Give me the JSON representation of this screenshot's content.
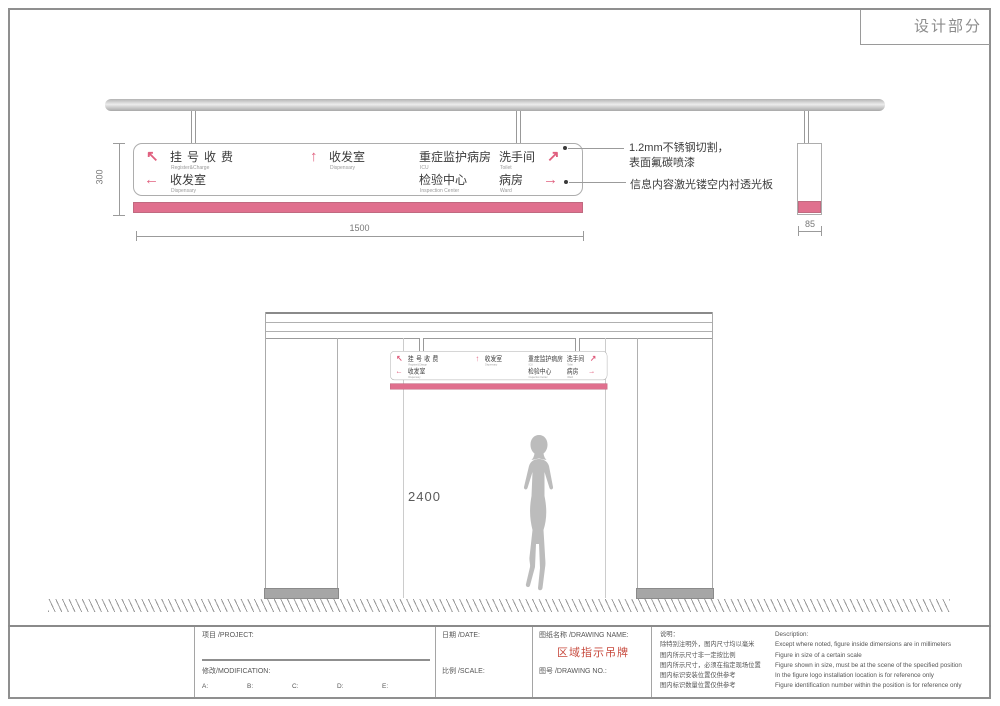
{
  "page": {
    "corner_label": "设计部分"
  },
  "colors": {
    "pink_band": "#e0708e",
    "arrow_pink": "#e0607f",
    "drawing_name_red": "#c84b3f"
  },
  "main_sign": {
    "row1": {
      "arrow_upleft": "↖",
      "dest1_cn": "挂号收费",
      "dest1_en": "Register&Charge",
      "arrow_up": "↑",
      "dest2_cn": "收发室",
      "dest2_en": "Dispensary",
      "dest3_cn": "重症监护病房",
      "dest3_en": "ICU",
      "dest4_cn": "洗手间",
      "dest4_en": "Toilet",
      "arrow_upright": "↗"
    },
    "row2": {
      "arrow_left": "←",
      "dest1_cn": "收发室",
      "dest1_en": "Dispensary",
      "dest2_cn": "检验中心",
      "dest2_en": "Inspection Center",
      "dest3_cn": "病房",
      "dest3_en": "Ward",
      "arrow_right": "→"
    }
  },
  "dimensions": {
    "sign_height": "300",
    "sign_width": "1500",
    "sign_depth": "85",
    "install_height": "2400"
  },
  "annotations": {
    "material_line1": "1.2mm不锈钢切割，",
    "material_line2": "表面氟碳喷漆",
    "lightpanel": "信息内容激光镂空内衬透光板"
  },
  "titleblock": {
    "project_label": "项目 /PROJECT:",
    "modification_label": "修改/MODIFICATION:",
    "revisions": [
      "A:",
      "B:",
      "C:",
      "D:",
      "E:"
    ],
    "date_label": "日期 /DATE:",
    "scale_label": "比例 /SCALE:",
    "drawing_name_label": "图纸名称 /DRAWING NAME:",
    "drawing_name": "区域指示吊牌",
    "drawing_no_label": "图号 /DRAWING NO.:",
    "notes_cn": [
      "说明：",
      "除特别注明外，图内尺寸均以毫米",
      "图内所示尺寸非一定按比例",
      "图内所示尺寸，必须在指定现场位置",
      "图内标识安装位置仅供参考",
      "图内标识数量位置仅供参考"
    ],
    "notes_en": [
      "Description:",
      "Except where noted, figure inside dimensions are in millimeters",
      "Figure in size of a certain scale",
      "Figure shown in size, must be at the scene of the specified position",
      "In the figure logo installation location is for reference only",
      "Figure identification number within the position is for reference only"
    ]
  }
}
